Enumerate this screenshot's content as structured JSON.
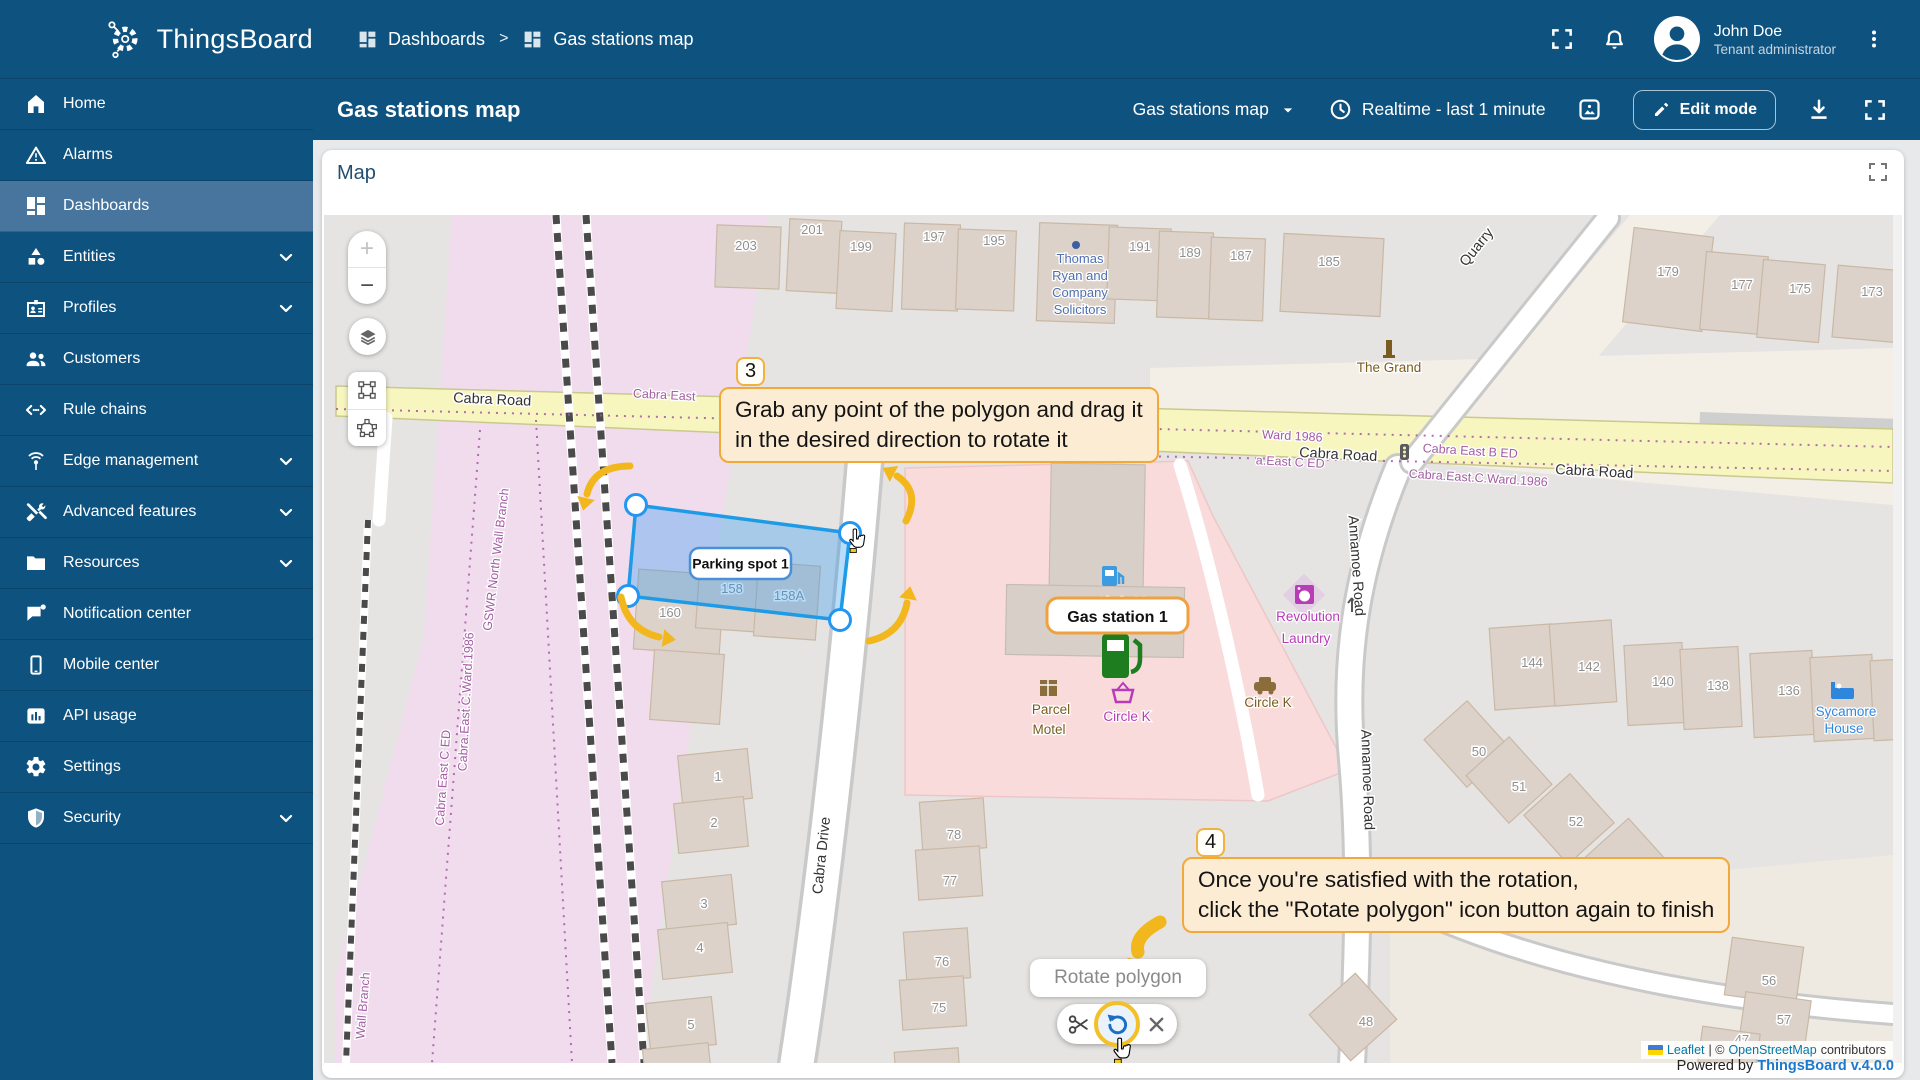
{
  "app": {
    "name": "ThingsBoard"
  },
  "topbar": {
    "breadcrumb_dashboards": "Dashboards",
    "breadcrumb_separator": ">",
    "breadcrumb_current": "Gas stations map",
    "user_name": "John Doe",
    "user_role": "Tenant administrator"
  },
  "toolbar": {
    "title": "Gas stations map",
    "dashboard_select": "Gas stations map",
    "time_window": "Realtime - last 1 minute",
    "edit_mode": "Edit mode"
  },
  "sidebar": {
    "items": [
      {
        "label": "Home"
      },
      {
        "label": "Alarms"
      },
      {
        "label": "Dashboards"
      },
      {
        "label": "Entities"
      },
      {
        "label": "Profiles"
      },
      {
        "label": "Customers"
      },
      {
        "label": "Rule chains"
      },
      {
        "label": "Edge management"
      },
      {
        "label": "Advanced features"
      },
      {
        "label": "Resources"
      },
      {
        "label": "Notification center"
      },
      {
        "label": "Mobile center"
      },
      {
        "label": "API usage"
      },
      {
        "label": "Settings"
      },
      {
        "label": "Security"
      }
    ]
  },
  "widget": {
    "title": "Map"
  },
  "map": {
    "controls": {
      "zoom_in": "+",
      "zoom_out": "−"
    },
    "polygon_label": "Parking spot 1",
    "gas_station_label": "Gas station 1",
    "tooltip3": {
      "number": "3",
      "line1": "Grab any point of the polygon and drag it",
      "line2": "in the desired direction to rotate it"
    },
    "tooltip4": {
      "number": "4",
      "line1": "Once you're satisfied with the rotation,",
      "line2": "click the \"Rotate polygon\" icon button again to finish"
    },
    "rotate_tooltip": "Rotate polygon",
    "attribution": {
      "leaflet": "Leaflet",
      "sep": "| ©",
      "osm": "OpenStreetMap",
      "contributors": "contributors"
    },
    "powered_prefix": "Powered by ",
    "powered_link": "ThingsBoard v.4.0.0",
    "labels": [
      {
        "t": "203"
      },
      {
        "t": "201"
      },
      {
        "t": "199"
      },
      {
        "t": "197"
      },
      {
        "t": "195"
      },
      {
        "t": "191"
      },
      {
        "t": "189"
      },
      {
        "t": "187"
      },
      {
        "t": "185"
      },
      {
        "t": "179"
      },
      {
        "t": "177"
      },
      {
        "t": "175"
      },
      {
        "t": "173"
      },
      {
        "t": "Thomas"
      },
      {
        "t": "Ryan and"
      },
      {
        "t": "Company"
      },
      {
        "t": "Solicitors"
      },
      {
        "t": "The Grand"
      },
      {
        "t": "Quarry"
      },
      {
        "t": "Cabra Road"
      },
      {
        "t": "Cabra East"
      },
      {
        "t": "Cabra Road"
      },
      {
        "t": "Cabra Road"
      },
      {
        "t": "Ward 1986"
      },
      {
        "t": "a.East C ED"
      },
      {
        "t": "Cabra East B ED"
      },
      {
        "t": "Cabra.East.C.Ward.1986"
      },
      {
        "t": "GSWR North Wall Branch"
      },
      {
        "t": "Cabra East C ED"
      },
      {
        "t": "Cabra.East.C.Ward.1986"
      },
      {
        "t": "Wall Branch"
      },
      {
        "t": "Cabra Drive"
      },
      {
        "t": "Annamoe Road"
      },
      {
        "t": "Annamoe Road"
      },
      {
        "t": "160"
      },
      {
        "t": "158"
      },
      {
        "t": "158A"
      },
      {
        "t": "1"
      },
      {
        "t": "2"
      },
      {
        "t": "3"
      },
      {
        "t": "4"
      },
      {
        "t": "5"
      },
      {
        "t": "78"
      },
      {
        "t": "77"
      },
      {
        "t": "76"
      },
      {
        "t": "75"
      },
      {
        "t": "144"
      },
      {
        "t": "142"
      },
      {
        "t": "140"
      },
      {
        "t": "138"
      },
      {
        "t": "136"
      },
      {
        "t": "Sycamore"
      },
      {
        "t": "House"
      },
      {
        "t": "50"
      },
      {
        "t": "51"
      },
      {
        "t": "52"
      },
      {
        "t": "48"
      },
      {
        "t": "56"
      },
      {
        "t": "57"
      },
      {
        "t": "47"
      },
      {
        "t": "Circle K"
      },
      {
        "t": "Circle K"
      },
      {
        "t": "Circle K"
      },
      {
        "t": "Parcel"
      },
      {
        "t": "Motel"
      },
      {
        "t": "Revolution"
      },
      {
        "t": "Laundry"
      }
    ]
  }
}
